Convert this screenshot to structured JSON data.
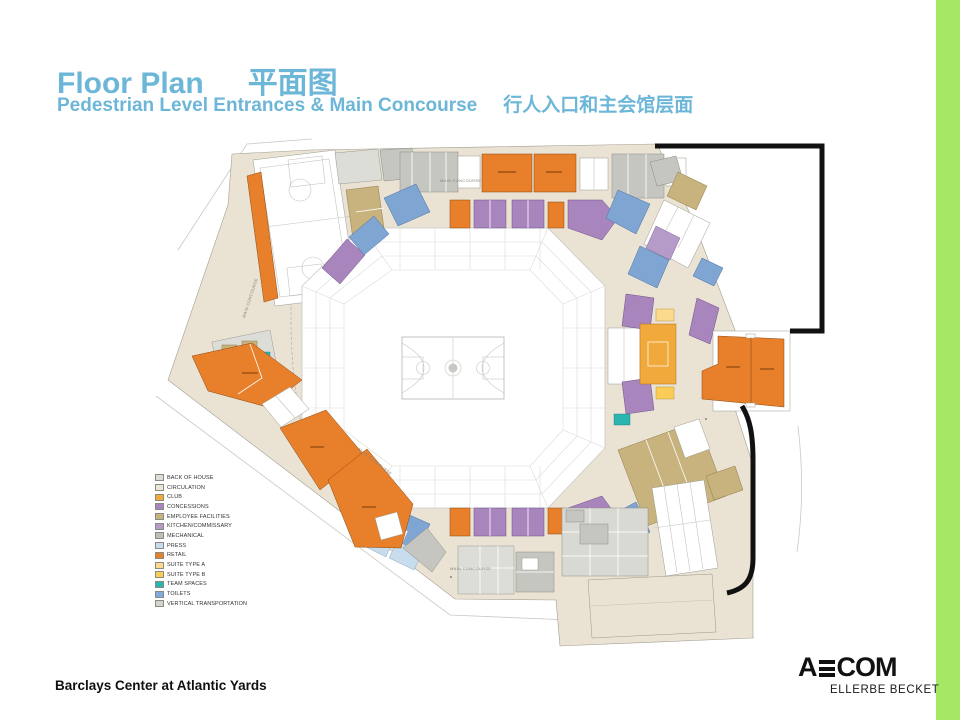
{
  "slide": {
    "title_en": "Floor Plan",
    "title_zh": "平面图",
    "subtitle_en": "Pedestrian Level Entrances & Main Concourse",
    "subtitle_zh": "行人入口和主会馆层面",
    "footer": "Barclays Center at Atlantic Yards",
    "accent_color": "#6CB6D8",
    "side_bar_color": "#A4E866"
  },
  "logo": {
    "aecom_prefix": "A",
    "aecom_suffix": "COM",
    "ellerbe": "ELLERBE BECKET"
  },
  "plan": {
    "concourse_label": "MAIN CONCOURSE"
  },
  "legend": {
    "items": [
      {
        "label": "BACK OF HOUSE",
        "color": "#DDDDD8"
      },
      {
        "label": "CIRCULATION",
        "color": "#EDE6D8"
      },
      {
        "label": "CLUB",
        "color": "#F2A93B"
      },
      {
        "label": "CONCESSIONS",
        "color": "#A886BD"
      },
      {
        "label": "EMPLOYEE FACILITIES",
        "color": "#C8B37E"
      },
      {
        "label": "KITCHEN/COMMISSARY",
        "color": "#B49BC8"
      },
      {
        "label": "MECHANICAL",
        "color": "#BFBFBA"
      },
      {
        "label": "PRESS",
        "color": "#C7DCEC"
      },
      {
        "label": "RETAIL",
        "color": "#E8802B"
      },
      {
        "label": "SUITE TYPE A",
        "color": "#FBDA90"
      },
      {
        "label": "SUITE TYPE B",
        "color": "#FBCD57"
      },
      {
        "label": "TEAM SPACES",
        "color": "#2BB5AF"
      },
      {
        "label": "TOILETS",
        "color": "#82AAD8"
      },
      {
        "label": "VERTICAL TRANSPORTATION",
        "color": "#D4D4CF"
      }
    ]
  }
}
